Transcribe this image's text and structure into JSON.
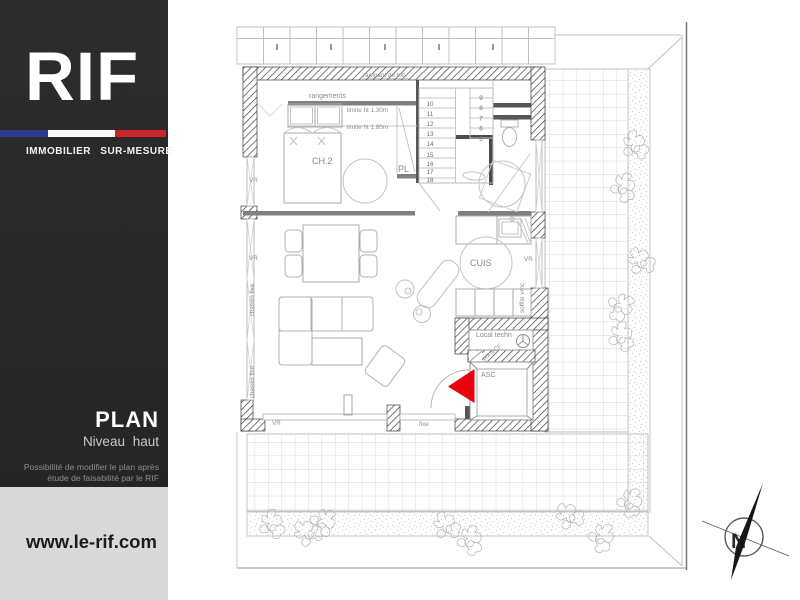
{
  "sidebar": {
    "logo": "RIF",
    "tagline": "IMMOBILIER SUR-MESURE",
    "flag_colors": {
      "blue": "#2e3a8e",
      "white": "#ffffff",
      "red": "#c9252b"
    },
    "plan_title": "PLAN",
    "plan_subtitle": "Niveau haut",
    "note_line1": "Possibilité de modifier le plan après",
    "note_line2": "étude de faisabilité par le RIF",
    "website": "www.le-rif.com"
  },
  "plan": {
    "labels": {
      "rampant": "rampant de toit",
      "rangements": "rangements",
      "limite_130": "limite ht 1.30m",
      "limite_180": "limite ht 1.80m",
      "ch2": "CH.2",
      "pl": "PL",
      "cuis": "CUIS",
      "local_techn": "Local techn",
      "porte_cf": "porteCF",
      "asc": "ASC",
      "soffite_vmc": "soffite vmc",
      "vr": "VR",
      "chassis_fixe": "chassis fixe",
      "fixe": "fixe",
      "compass_n": "N"
    },
    "stairs": {
      "left": [
        "10",
        "11",
        "12",
        "13",
        "14",
        "15",
        "16",
        "17",
        "18"
      ],
      "right": [
        "9",
        "8",
        "7",
        "6",
        "5"
      ]
    },
    "colors": {
      "accent_red": "#e8000d",
      "wall": "#3a3a3a",
      "line": "#b8b8b8"
    }
  }
}
